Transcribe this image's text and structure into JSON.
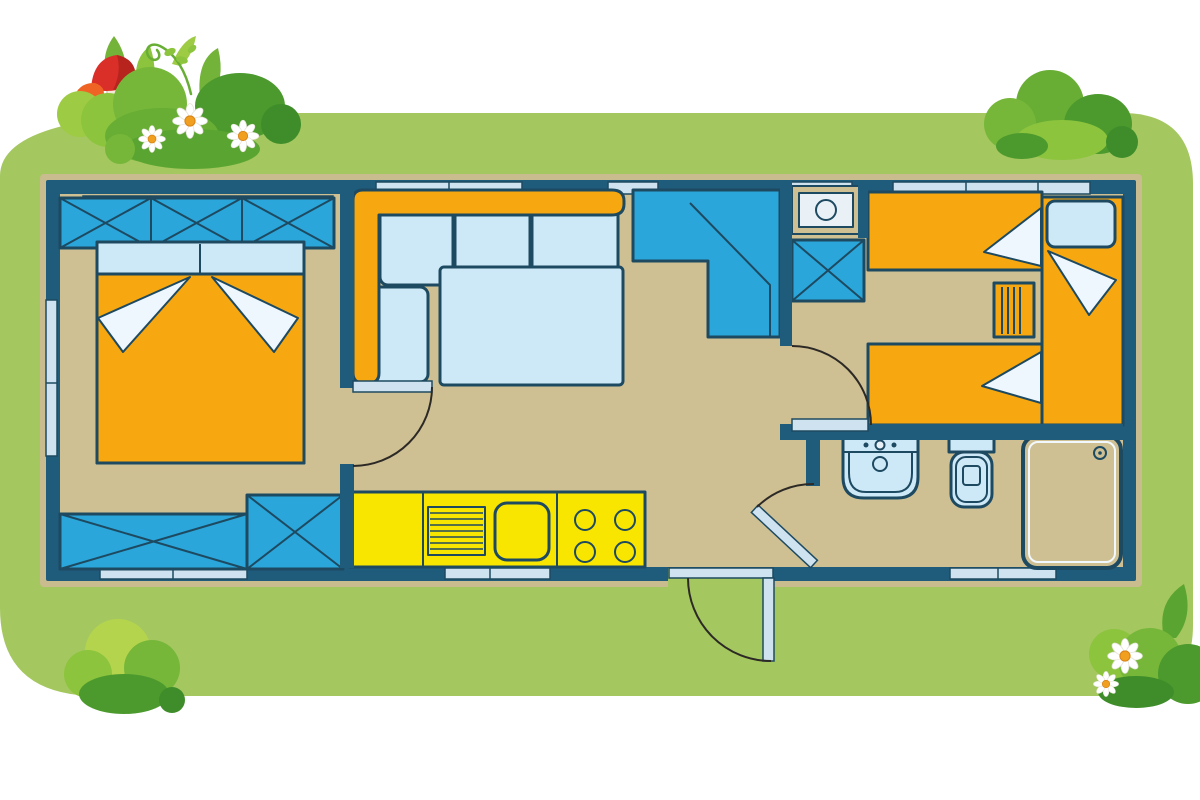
{
  "scene": {
    "type": "mobile-home-floor-plan-illustration",
    "setting": "top-down caravan layout drawn on a green lawn card with decorative bushes, flowers and mushrooms",
    "rooms": [
      {
        "id": "master-bedroom",
        "furniture": [
          "wardrobe-3-sections",
          "double-bed",
          "bench-chest",
          "corner-cabinet"
        ]
      },
      {
        "id": "living-area",
        "furniture": [
          "corner-sofa",
          "dining-table",
          "corner-wardrobe"
        ]
      },
      {
        "id": "kitchen",
        "furniture": [
          "counter",
          "vent-grill",
          "sink",
          "stove-4-burners"
        ]
      },
      {
        "id": "hallway-niche",
        "furniture": [
          "boiler-appliance",
          "storage-cabinet"
        ]
      },
      {
        "id": "kids-bedroom",
        "furniture": [
          "single-bed-top",
          "single-bed-bottom",
          "single-bed-right",
          "drawer-unit"
        ]
      },
      {
        "id": "bathroom",
        "furniture": [
          "washbasin",
          "toilet",
          "shower"
        ]
      }
    ],
    "doors": [
      "master-bedroom-door",
      "kids-bedroom-door",
      "bathroom-door",
      "entrance-door"
    ],
    "decorations": [
      "bush-cluster-top-left",
      "bush-top-right",
      "bush-bottom-left",
      "bush-bottom-right",
      "red-mushroom",
      "orange-mushroom",
      "daisies",
      "vine"
    ]
  },
  "palette": {
    "page_bg": "#ffffff",
    "lawn_green": "#a4c75f",
    "plan_trim": "#c9bc8e",
    "wall_dark": "#1f5b7a",
    "floor_tan": "#cfc094",
    "furniture_blue": "#2aa6da",
    "bed_orange": "#f7a70f",
    "kitchen_yellow": "#f9e600",
    "soft_blue": "#cde9f7",
    "fold_white": "#eef7fd",
    "window_glass": "#cfe2f0",
    "outline_dark": "#1e4a61",
    "appliance_white": "#e9f1f7",
    "bush_light": "#9ecb44",
    "bush_light2": "#8cc43d",
    "bush_mid": "#76b73a",
    "bush_mid2": "#68ae35",
    "bush_dark": "#4c9a2d",
    "bush_deep": "#3e8d2a",
    "bush_front": "#5aa531",
    "bush_yellow": "#b5d44e",
    "leaf_green": "#74b33a",
    "mushroom_red": "#d92f28",
    "mushroom_red_dark": "#b7231d",
    "mushroom_orange": "#ef6425",
    "mushroom_stem": "#f3ead9",
    "daisy_petal": "#ffffff",
    "daisy_center": "#f0a01e"
  }
}
